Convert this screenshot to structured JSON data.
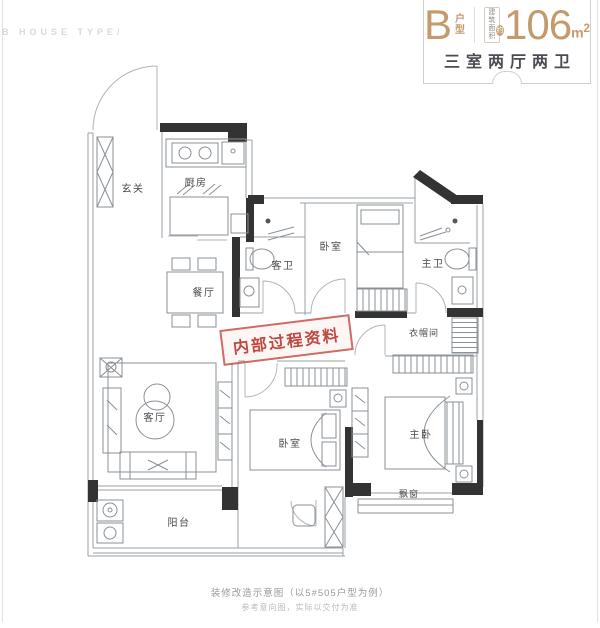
{
  "header": {
    "corner_text": "B HOUSE TYPE/"
  },
  "badge": {
    "type_letter": "B",
    "type_suffix_1": "户",
    "type_suffix_2": "型",
    "area_label_line1": "建筑",
    "area_label_line2": "面积",
    "area_approx": "约",
    "area_value": "106",
    "area_unit_base": "m",
    "area_unit_sup": "2",
    "layout_summary": "三室两厅两卫"
  },
  "rooms": {
    "entry": "玄关",
    "kitchen": "厨房",
    "dining": "餐厅",
    "guest_bath": "客卫",
    "bedroom1": "卧室",
    "master_bath": "主卫",
    "cloakroom": "衣帽间",
    "living": "客厅",
    "bedroom2": "卧室",
    "master_bedroom": "主卧",
    "balcony": "阳台",
    "bay_window": "飘窗"
  },
  "stamp": {
    "text": "内部过程资料"
  },
  "footer": {
    "line1": "装修改造示意图（以5#505户型为例）",
    "line2": "参考意向图，实际以交付为准"
  },
  "colors": {
    "accent_tan": "#c49a6c",
    "dark_text": "#4b4b52",
    "stamp_red": "#b53128",
    "wall_black": "#333333",
    "wall_gray": "#9aa0a6"
  }
}
